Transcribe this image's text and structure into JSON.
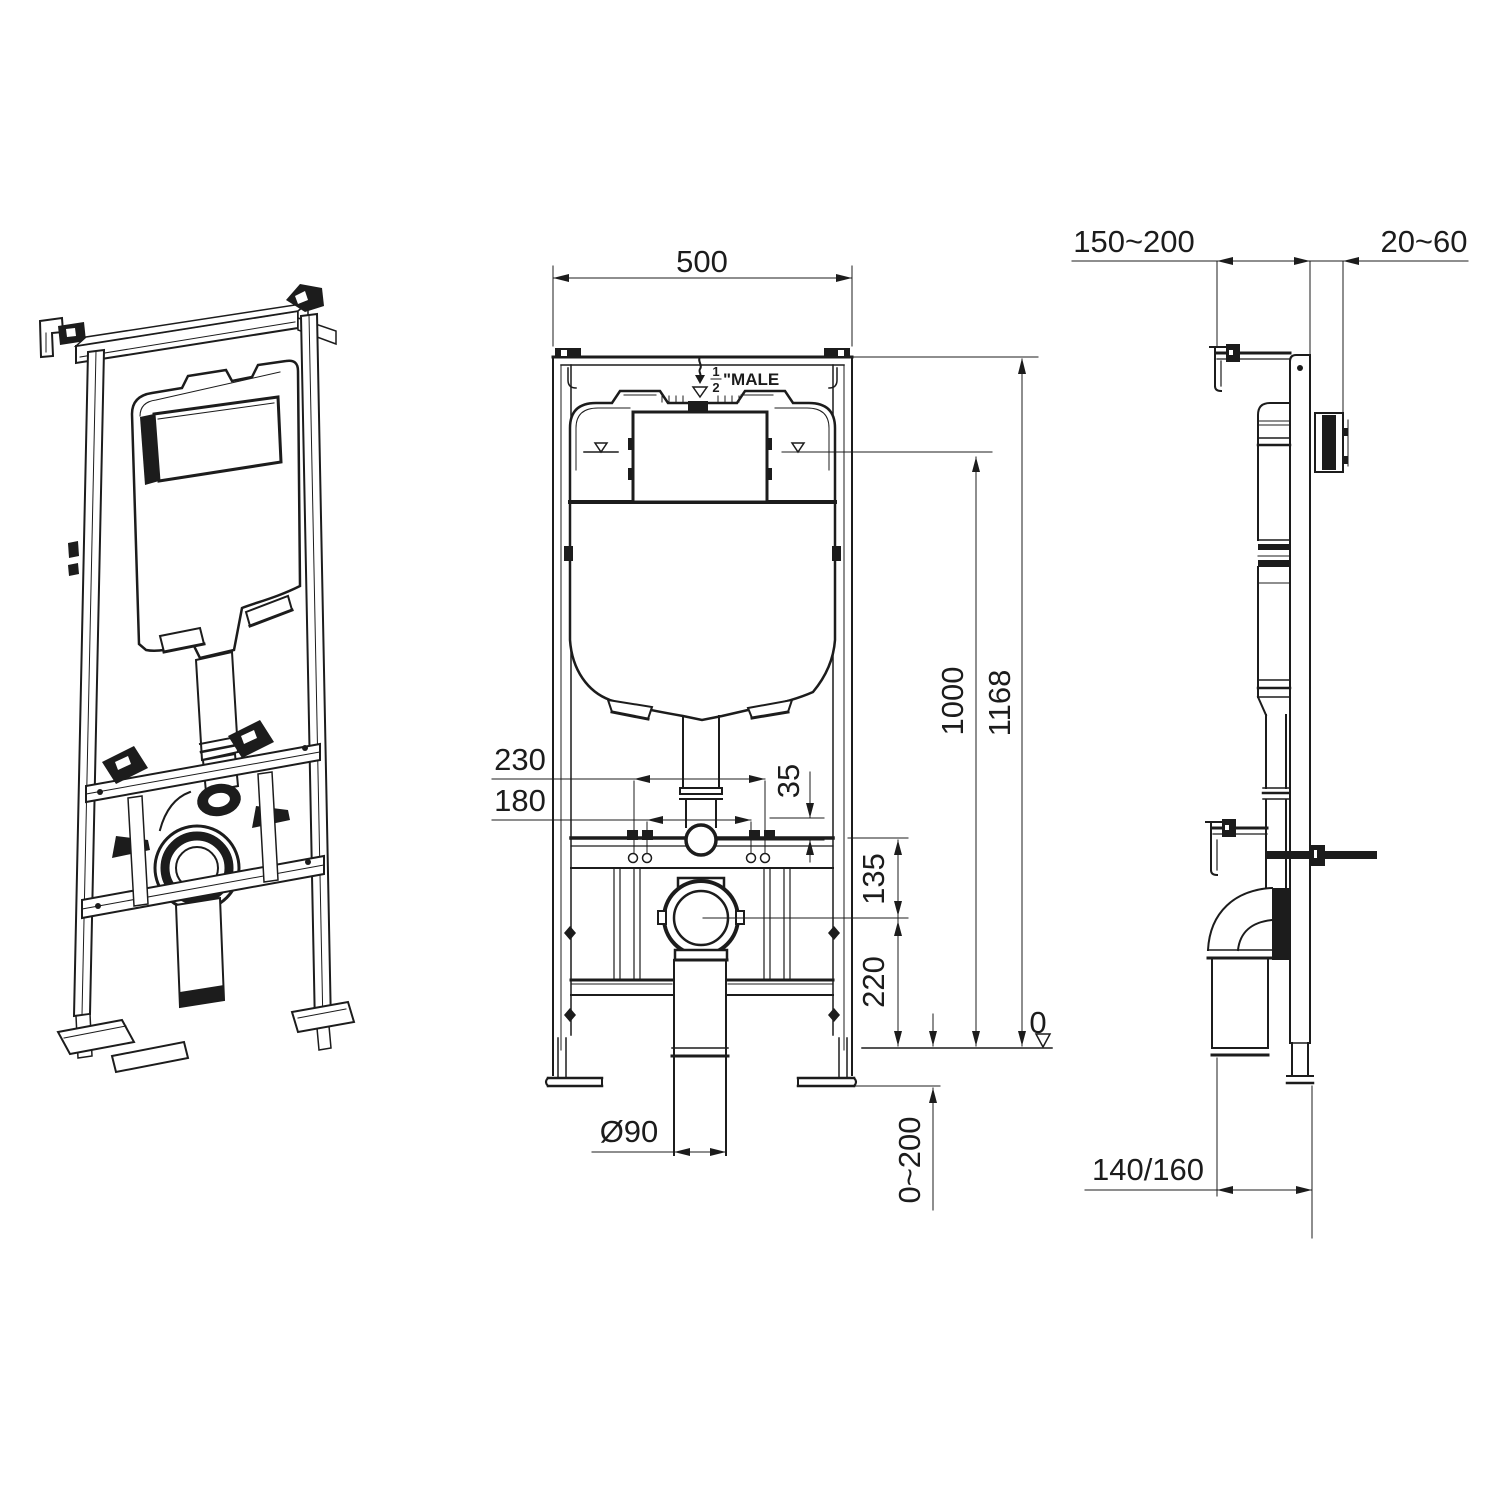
{
  "meta": {
    "type": "technical-drawing",
    "subject": "concealed cistern wall-hung WC frame",
    "line_color": "#1c1c1c",
    "background": "#ffffff"
  },
  "front": {
    "width": "500",
    "total_height": "1168",
    "tank_water_height": "1000",
    "fixing_spacing_outer": "230",
    "fixing_spacing_inner": "180",
    "inlet_offset": "35",
    "flush_to_drain": "135",
    "drain_center_height": "220",
    "drain_pipe_diameter": "Ø90",
    "floor_level": "0",
    "foot_adjust_range": "0~200",
    "supply": {
      "numerator": "1",
      "denominator": "2",
      "suffix": "\"MALE"
    }
  },
  "side": {
    "frame_to_wall": "150~200",
    "plate_depth": "20~60",
    "outlet_depth": "140/160"
  }
}
